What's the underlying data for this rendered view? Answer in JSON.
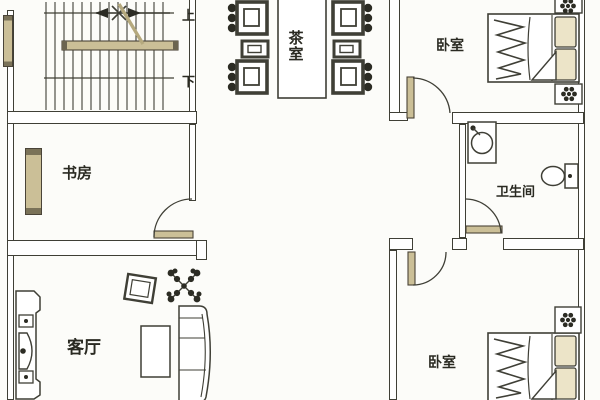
{
  "plan": {
    "title": "residential-floor-plan",
    "rooms": [
      {
        "id": "tea-room",
        "label": "茶室"
      },
      {
        "id": "bedroom-top",
        "label": "卧室"
      },
      {
        "id": "study",
        "label": "书房"
      },
      {
        "id": "bathroom",
        "label": "卫生间"
      },
      {
        "id": "living-room",
        "label": "客厅"
      },
      {
        "id": "bedroom-bottom",
        "label": "卧室"
      }
    ],
    "stairs": {
      "up": "上",
      "down": "下"
    },
    "colors": {
      "line": "#3f3f36",
      "furniture_dark": "#2c2c24",
      "wood_tan": "#cbbf97",
      "background": "#fcfcf9"
    }
  }
}
